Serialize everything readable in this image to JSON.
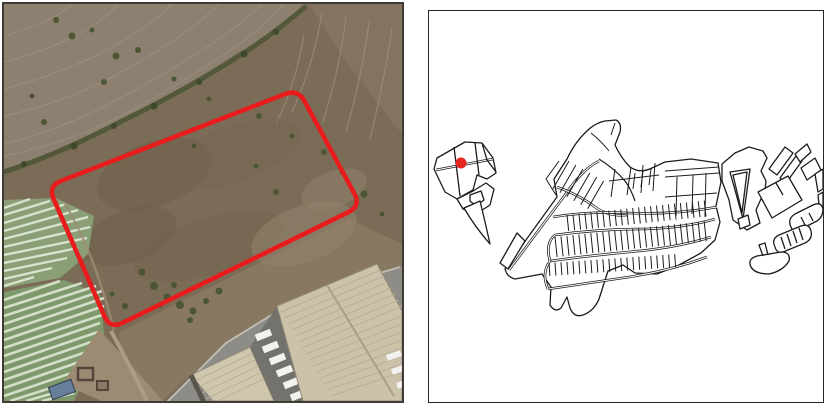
{
  "figure": {
    "kind": "two-panel site location figure",
    "left_panel": {
      "name": "satellite-aerial-view",
      "features": [
        "site-boundary-outline",
        "ploughed-field",
        "scrubland",
        "crop-row-fields",
        "dirt-track",
        "warehouse-building",
        "parked-trucks"
      ]
    },
    "right_panel": {
      "name": "cadastral-parcel-map",
      "features": [
        "parcel-outlines",
        "street-network",
        "site-location-marker"
      ]
    }
  },
  "colors": {
    "site_outline": "#e81c1c",
    "location_marker": "#e8251f",
    "map_line": "#1c1c1c",
    "map_background": "#ffffff",
    "panel_border": "#403b34",
    "terrain_brown": "#7b6c58",
    "ploughed_field": "#8e8070",
    "crop_green": "#7e9a6c",
    "crop_row_pale": "#dbe4cf",
    "vegetation_dark": "#46532f",
    "roof_beige": "#cfc6ae",
    "asphalt_gray": "#8e8c86",
    "truck_white": "#f2f2ef"
  }
}
